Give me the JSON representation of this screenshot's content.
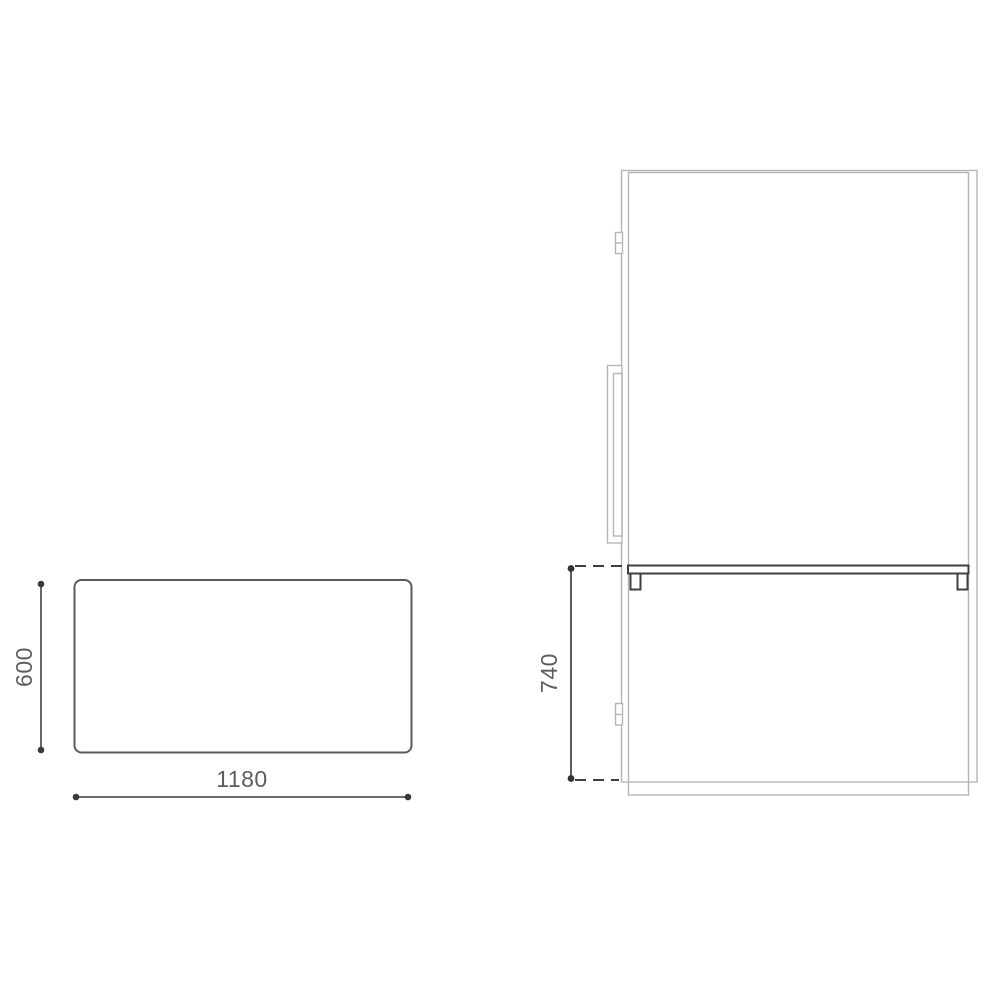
{
  "drawing_title": "furniture-dimension-drawing",
  "colors": {
    "background": "#ffffff",
    "light_outline": "#b6b6b6",
    "dark_outline": "#3f3f3f",
    "dimension_line": "#565656",
    "label_text": "#5d5d5d"
  },
  "top_view": {
    "depth_label": "600",
    "width_label": "1180"
  },
  "side_view": {
    "height_label": "740"
  }
}
